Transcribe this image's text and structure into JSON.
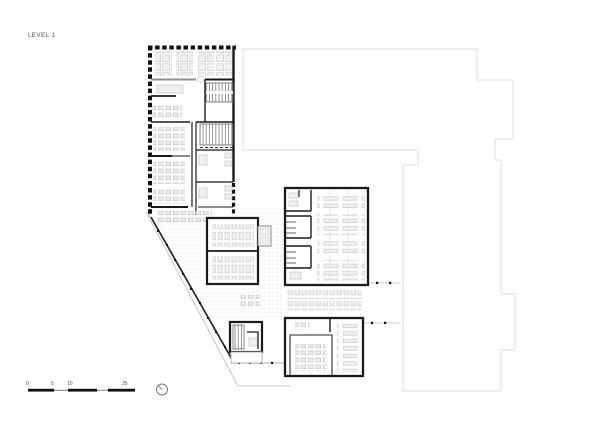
{
  "title_block": {
    "label": "LEVEL 1"
  },
  "scale_bar": {
    "labels": [
      "0",
      "5",
      "10",
      "25"
    ]
  },
  "icons": {
    "north_indicator": "north-arrow-icon"
  },
  "colors": {
    "background": "#ffffff",
    "wall": "#1a1a1a",
    "partition": "#3a3a3a",
    "gray_wall": "#8f8f8f",
    "context_outline": "#dcdcdc",
    "furniture_stroke": "#c3c3c3",
    "furniture_fill": "#efefef",
    "floor_grid": "#ebebeb",
    "text": "#4d4d4d"
  }
}
